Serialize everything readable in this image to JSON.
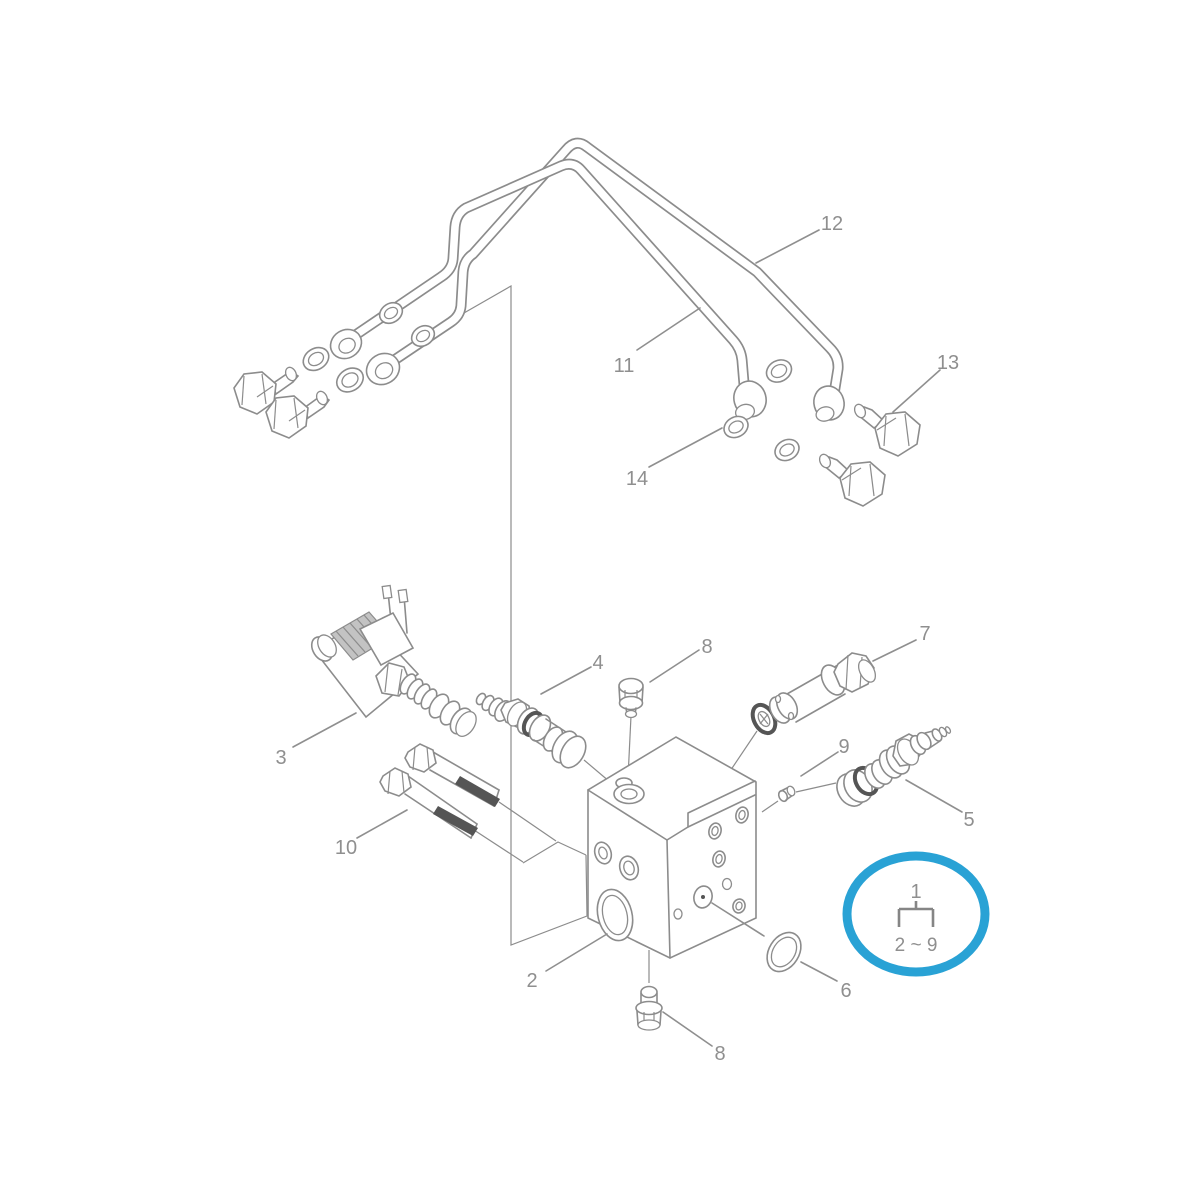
{
  "diagram_type": "exploded-parts-diagram",
  "labels": {
    "p1": "1",
    "p2": "2",
    "p3": "3",
    "p4": "4",
    "p5": "5",
    "p6": "6",
    "p7": "7",
    "p8": "8",
    "p9": "9",
    "p10": "10",
    "p11": "11",
    "p12": "12",
    "p13": "13",
    "p14": "14"
  },
  "callout": {
    "top": "1",
    "bottom": "2 ~ 9"
  },
  "colors": {
    "line": "#8c8c8c",
    "label": "#8f8f8f",
    "dark": "#555555",
    "highlight": "#29a2d5",
    "background": "#ffffff"
  }
}
